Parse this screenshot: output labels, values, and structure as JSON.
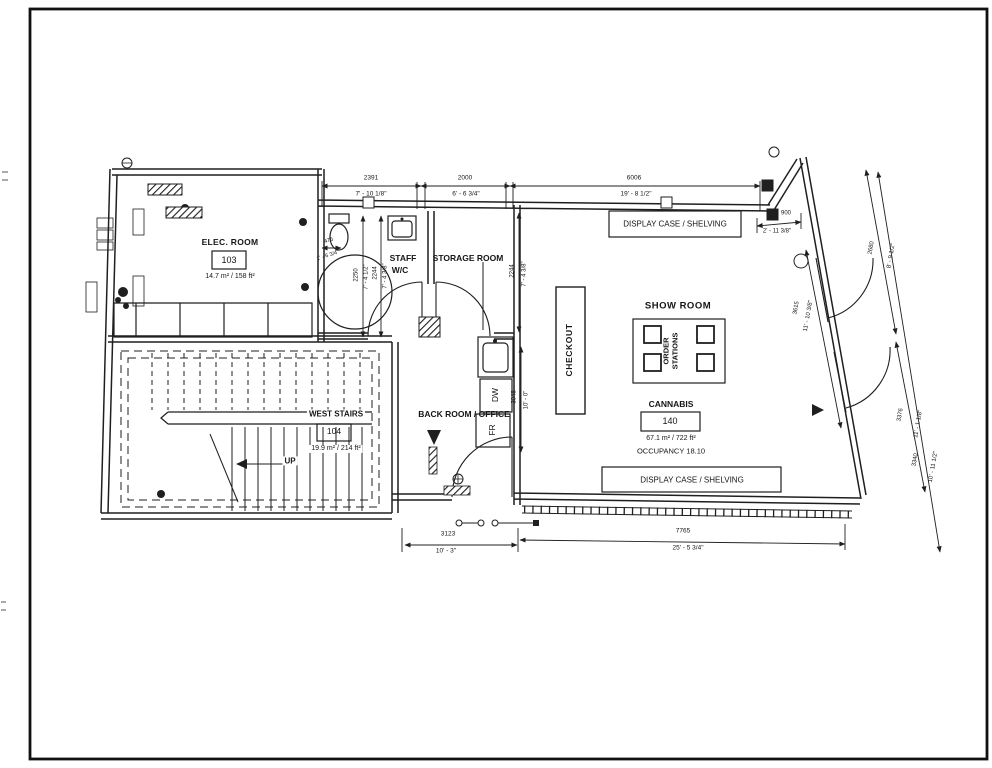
{
  "drawing": {
    "line_color": "#1f1f1f",
    "rooms": {
      "elec": {
        "name": "ELEC. ROOM",
        "number": "103",
        "area": "14.7 m² / 158 ft²"
      },
      "west_stairs": {
        "name": "WEST STAIRS",
        "number": "104",
        "area": "19.9 m² / 214 ft²"
      },
      "staff_wc": {
        "line1": "STAFF",
        "line2": "W/C"
      },
      "storage": {
        "name": "STORAGE ROOM"
      },
      "back_room": {
        "name": "BACK ROOM / OFFICE"
      },
      "show_room": {
        "name": "SHOW ROOM"
      },
      "cannabis": {
        "name": "CANNABIS",
        "number": "140",
        "area": "67.1 m² / 722 ft²",
        "occupancy": "OCCUPANCY 18.10"
      }
    },
    "fixtures": {
      "checkout": "CHECKOUT",
      "order_stations_line1": "ORDER",
      "order_stations_line2": "STATIONS",
      "display_case_top": "DISPLAY CASE / SHELVING",
      "display_case_bottom": "DISPLAY CASE / SHELVING",
      "fridge": "FR",
      "dishwasher": "DW",
      "stairs_up": "UP"
    },
    "dimensions": {
      "top": [
        {
          "mm": "2391",
          "ft": "7' - 10 1/8\""
        },
        {
          "mm": "2000",
          "ft": "6' - 6 3/4\""
        },
        {
          "mm": "6006",
          "ft": "19' - 8 1/2\""
        }
      ],
      "bottom": [
        {
          "mm": "3123",
          "ft": "10' - 3\""
        },
        {
          "mm": "7765",
          "ft": "25' - 5 3/4\""
        }
      ],
      "right": [
        {
          "mm": "900",
          "ft": "2' - 11 3/8\""
        },
        {
          "mm": "3615",
          "ft": "11' - 10 3/8\""
        },
        {
          "mm": "2680",
          "ft": "8' - 9 1/2\""
        },
        {
          "mm": "3376",
          "ft": "11' - 1 1/8\""
        },
        {
          "mm": "3340",
          "ft": "10' - 11 1/2\""
        }
      ],
      "interior": [
        {
          "mm": "475",
          "ft": "1' - 6 3/4\""
        },
        {
          "mm": "2250",
          "ft": "7' - 4 1/2\""
        },
        {
          "mm": "2244",
          "ft": "7' - 4 3/8\""
        },
        {
          "mm": "2244",
          "ft": "7' - 4 3/8\""
        },
        {
          "mm": "3048",
          "ft": "10' - 0\""
        }
      ]
    }
  }
}
